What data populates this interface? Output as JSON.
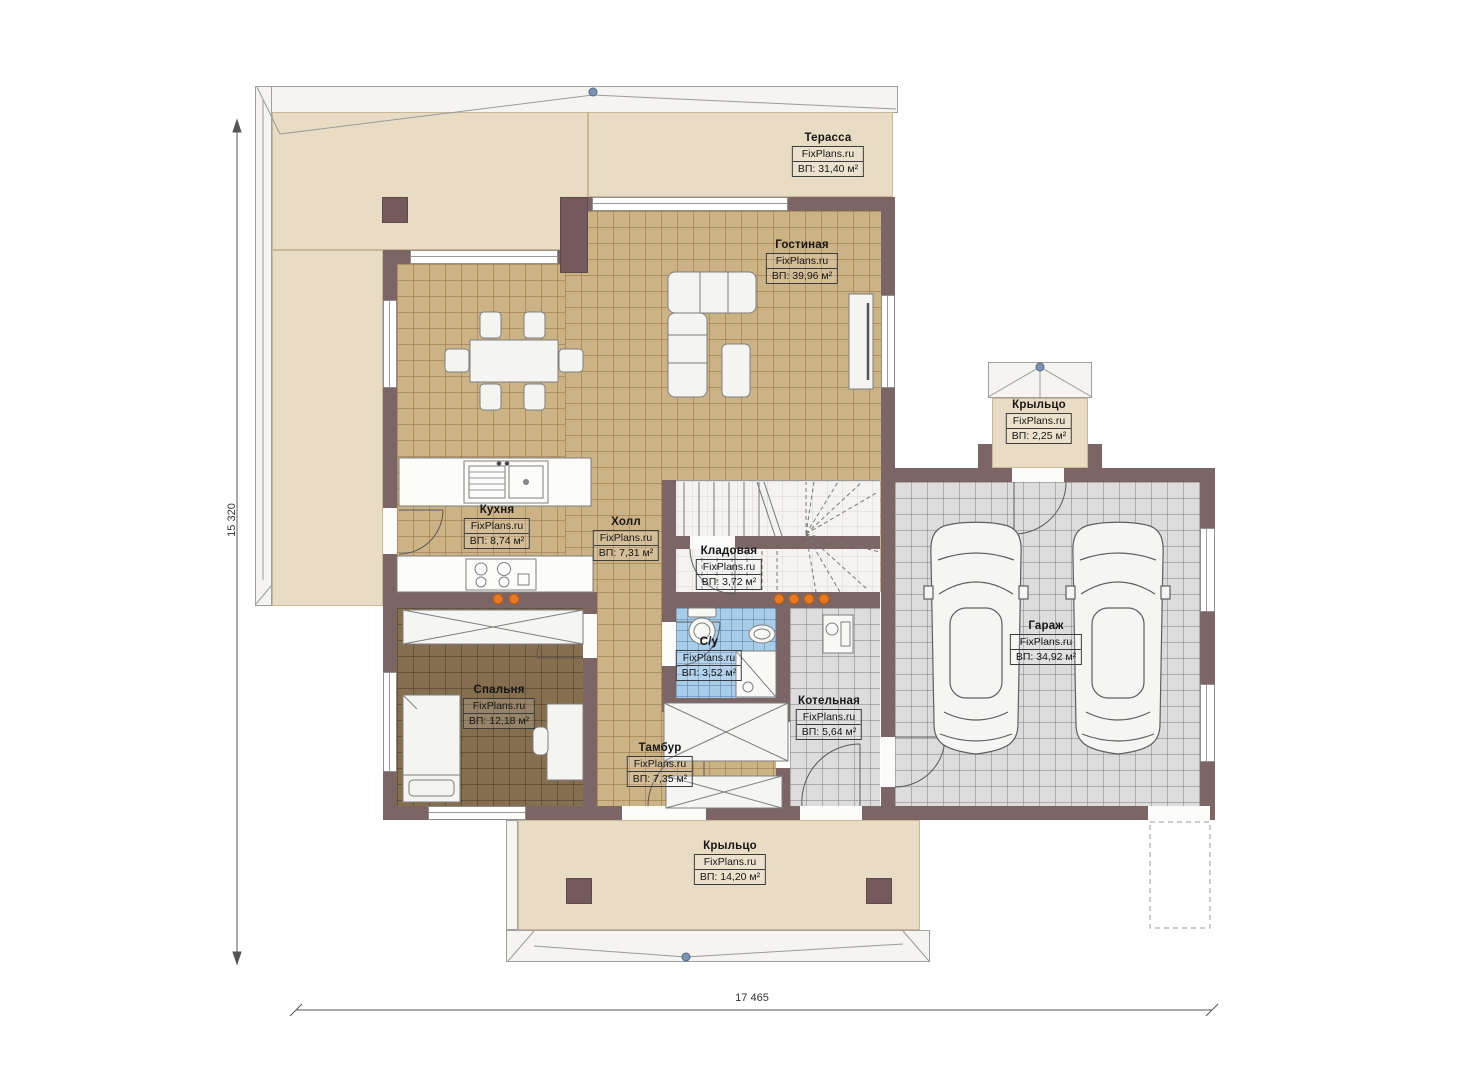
{
  "plan": {
    "brand": "FixPlans.ru",
    "rooms": {
      "terrace": {
        "name": "Терасса",
        "area": "ВП: 31,40 м²"
      },
      "living": {
        "name": "Гостиная",
        "area": "ВП: 39,96 м²"
      },
      "kitchen": {
        "name": "Кухня",
        "area": "ВП: 8,74 м²"
      },
      "hall": {
        "name": "Холл",
        "area": "ВП: 7,31 м²"
      },
      "storage": {
        "name": "Кладовая",
        "area": "ВП: 3,72 м²"
      },
      "bathroom": {
        "name": "С/у",
        "area": "ВП: 3,52 м²"
      },
      "bedroom": {
        "name": "Спальня",
        "area": "ВП: 12,18 м²"
      },
      "vestibule": {
        "name": "Тамбур",
        "area": "ВП: 7,35 м²"
      },
      "boiler": {
        "name": "Котельная",
        "area": "ВП: 5,64 м²"
      },
      "garage": {
        "name": "Гараж",
        "area": "ВП: 34,92 м²"
      },
      "porch_top": {
        "name": "Крыльцо",
        "area": "ВП: 2,25 м²"
      },
      "porch_bottom": {
        "name": "Крыльцо",
        "area": "ВП: 14,20 м²"
      }
    },
    "dimensions": {
      "height": "15 320",
      "width": "17 465"
    },
    "colors": {
      "wall": "#7b6565",
      "floor_tan": "#ccb386",
      "floor_beige": "#e9dcc4",
      "floor_gray": "#dcdcdc",
      "floor_blue": "#a8cde9",
      "floor_brown": "#856f4e",
      "marker_orange": "#e8791f"
    }
  }
}
